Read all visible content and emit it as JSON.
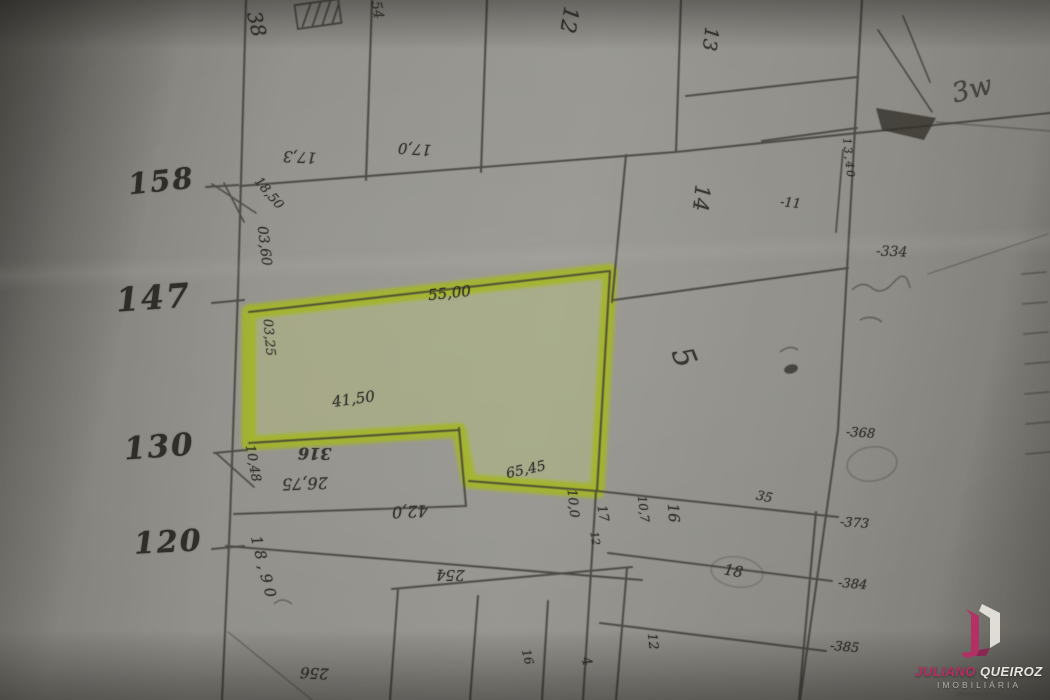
{
  "ruler": [
    {
      "label": "158"
    },
    {
      "label": "147"
    },
    {
      "label": "130"
    },
    {
      "label": "120"
    }
  ],
  "annotations": {
    "lot_38": "38",
    "lot_54": "54",
    "lot_12": "12",
    "dim_17_3": "17,3",
    "dim_17_0": "17,0",
    "lot_13": "13",
    "scribble_3w": "3w",
    "lot_14": "14",
    "num_11": "-11",
    "dim_13_40": "13,40",
    "num_334": "-334",
    "lot_5": "5",
    "num_368": "-368",
    "num_373": "-373",
    "num_384": "-384",
    "num_385": "-385",
    "dim_18_50": "18,50",
    "dim_03_60": "03,60",
    "dim_03_25": "03,25",
    "dim_55_00": "55,00",
    "dim_41_50": "41,50",
    "dim_65_45": "65,45",
    "lot_316": "316",
    "dim_26_75": "26,75",
    "dim_10_48": "10,48",
    "dim_42_0": "42,0",
    "dim_18_90": "18,90",
    "dim_10_0": "10,0",
    "num_17": "17",
    "num_12": "12",
    "dim_10_7": "10,7",
    "lot_16": "16",
    "num_35": "35",
    "lot_18": "18",
    "lot_254": "254",
    "lot_256": "256",
    "sub_16": "16",
    "sub_4": "4",
    "sub_12": "12"
  },
  "watermark": {
    "first": "JULIANO",
    "last": "QUEIROZ",
    "subtitle": "IMOBILIÁRIA"
  },
  "colors": {
    "highlight_green": "#c3d92b",
    "logo_magenta": "#b62d64"
  }
}
